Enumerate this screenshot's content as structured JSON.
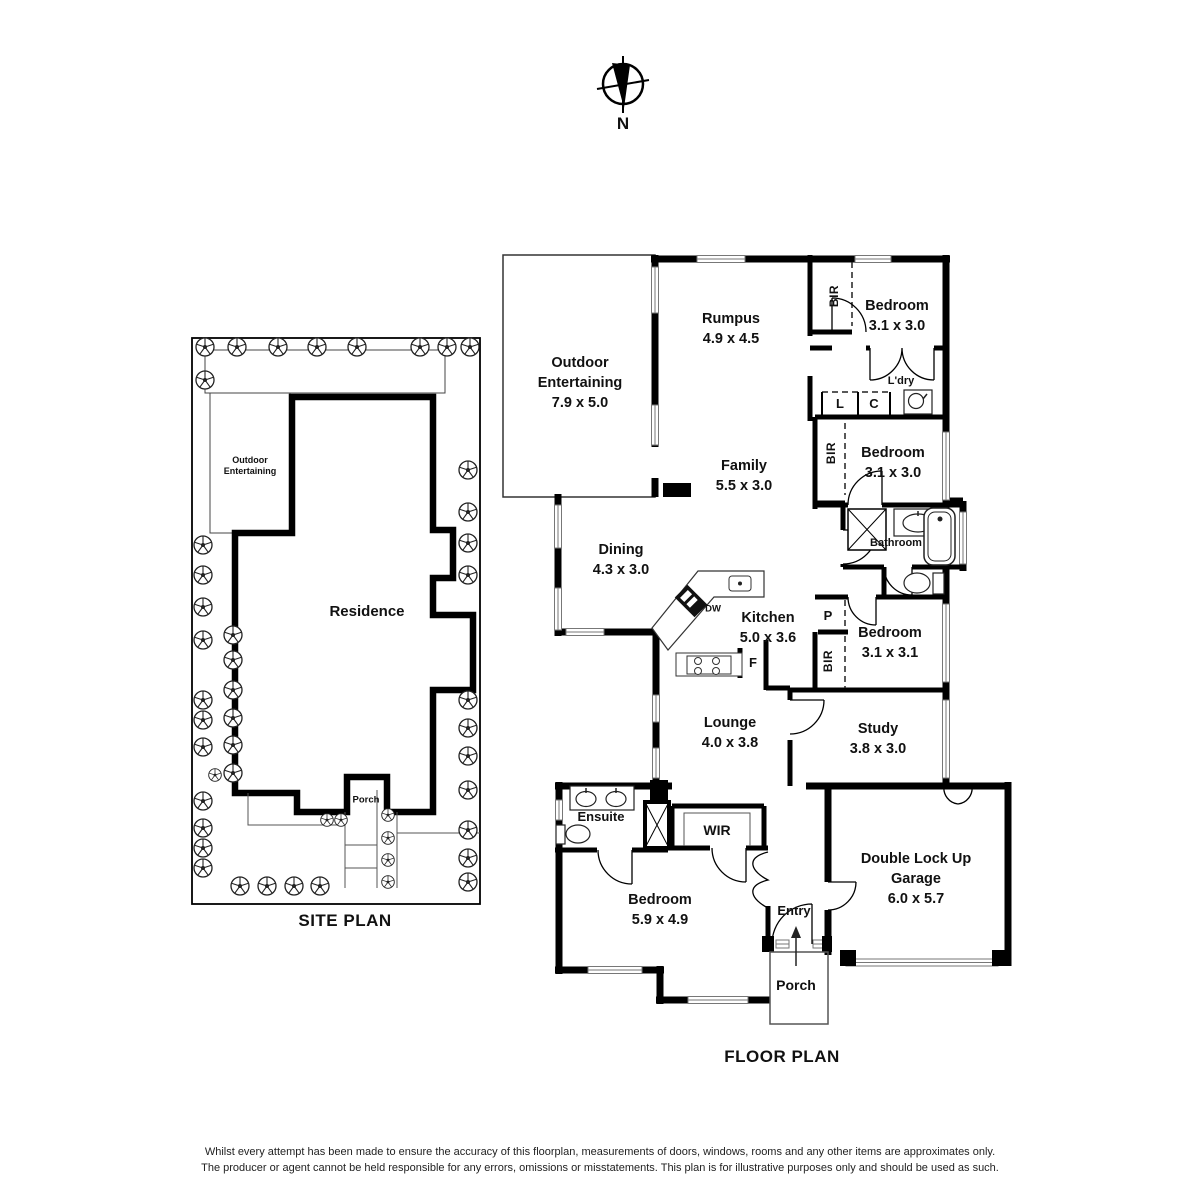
{
  "north": {
    "label": "N"
  },
  "site_plan": {
    "title": "SITE PLAN",
    "labels": {
      "outdoor": "Outdoor Entertaining",
      "residence": "Residence",
      "porch": "Porch"
    }
  },
  "floor_plan": {
    "title": "FLOOR PLAN",
    "rooms": {
      "outdoor": {
        "name": "Outdoor Entertaining",
        "dims": "7.9 x 5.0"
      },
      "rumpus": {
        "name": "Rumpus",
        "dims": "4.9 x 4.5"
      },
      "bedroom1": {
        "name": "Bedroom",
        "dims": "3.1 x 3.0"
      },
      "bedroom2": {
        "name": "Bedroom",
        "dims": "3.1 x 3.0"
      },
      "family": {
        "name": "Family",
        "dims": "5.5 x 3.0"
      },
      "dining": {
        "name": "Dining",
        "dims": "4.3 x 3.0"
      },
      "kitchen": {
        "name": "Kitchen",
        "dims": "5.0 x 3.6"
      },
      "bedroom3": {
        "name": "Bedroom",
        "dims": "3.1 x 3.1"
      },
      "lounge": {
        "name": "Lounge",
        "dims": "4.0 x 3.8"
      },
      "study": {
        "name": "Study",
        "dims": "3.8 x 3.0"
      },
      "bedroom4": {
        "name": "Bedroom",
        "dims": "5.9 x 4.9"
      },
      "garage": {
        "name": "Double Lock Up Garage",
        "dims": "6.0 x 5.7"
      }
    },
    "small_labels": {
      "ldry": "L'dry",
      "bathroom": "Bathroom",
      "ensuite": "Ensuite",
      "wir": "WIR",
      "entry": "Entry",
      "porch": "Porch",
      "bir": "BIR",
      "linen": "L",
      "cupboard": "C",
      "pantry": "P",
      "dishwasher": "DW",
      "fridge": "F"
    }
  },
  "disclaimer": {
    "line1": "Whilst every attempt has been made to ensure the accuracy of this floorplan, measurements of doors, windows, rooms and any other items are approximates only.",
    "line2": "The producer or agent cannot be held responsible for any errors, omissions or misstatements. This plan is for illustrative purposes only and should be used as such."
  },
  "colors": {
    "wall": "#000000",
    "background": "#ffffff",
    "window_line": "#777777"
  }
}
